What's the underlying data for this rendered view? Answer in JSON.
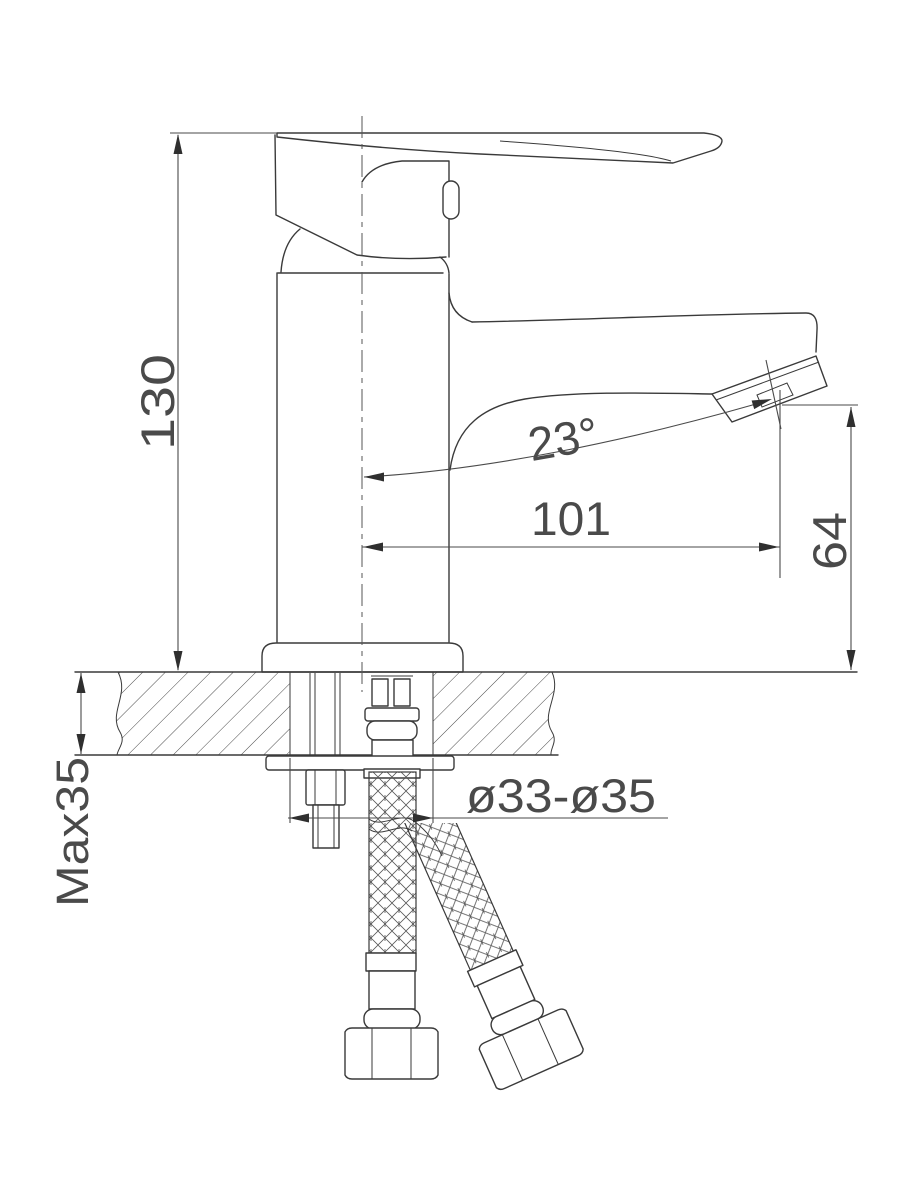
{
  "dims": {
    "height": "130",
    "reach": "101",
    "angle": "23°",
    "outlet_height": "64",
    "deck": "Max35",
    "hole": "ø33-ø35"
  },
  "colors": {
    "line": "#3a3a3a",
    "dimension_text": "#4a4a4a",
    "background": "#ffffff"
  }
}
